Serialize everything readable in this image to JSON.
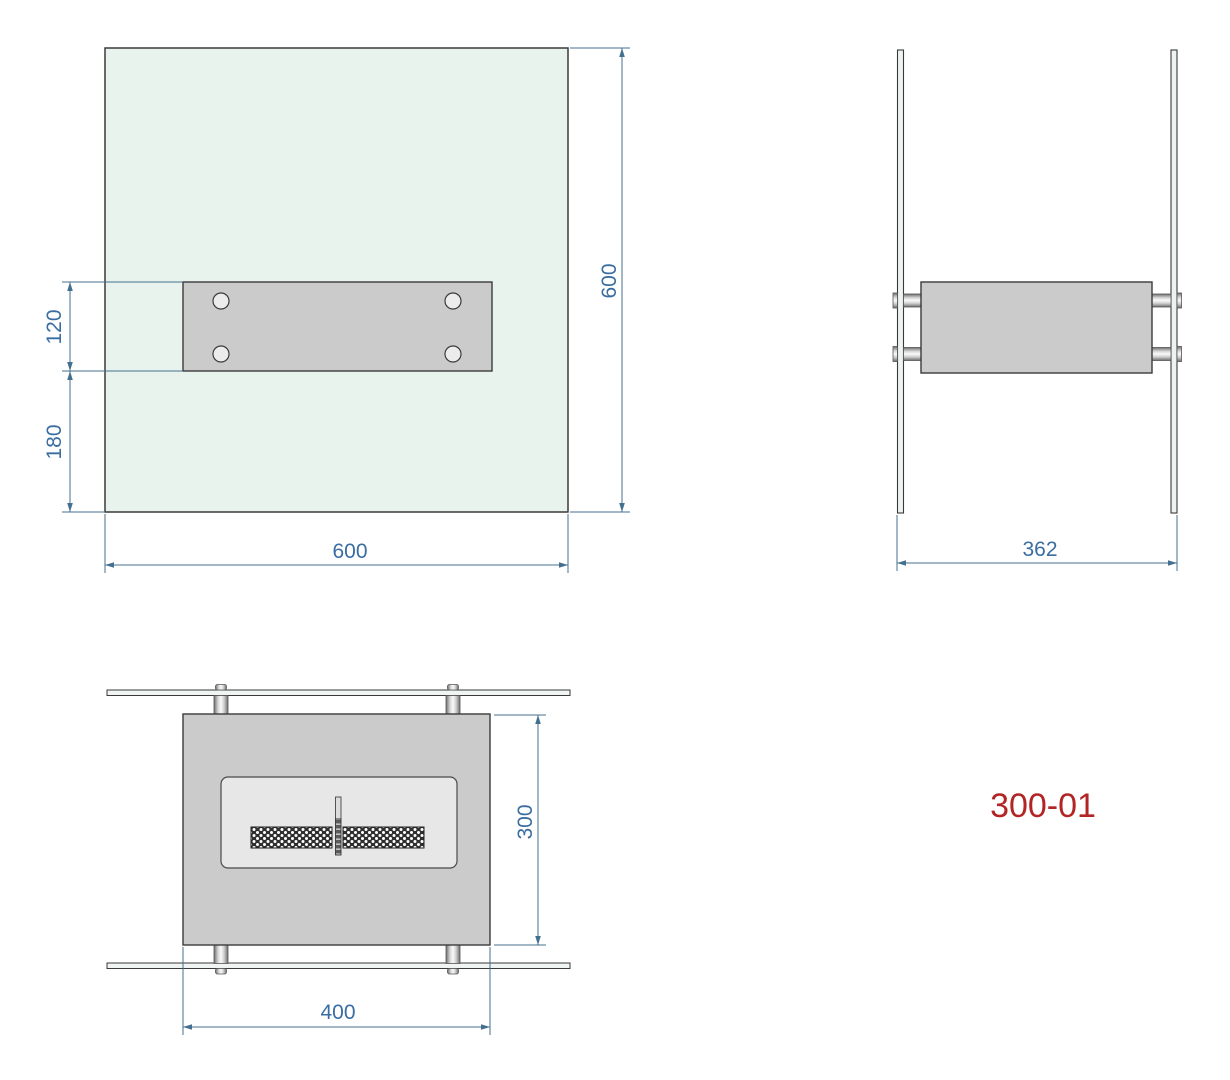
{
  "part_number": "300-01",
  "dims": {
    "front_width": "600",
    "front_height": "600",
    "bracket_height": "120",
    "bracket_offset_bottom": "180",
    "side_depth": "362",
    "top_width": "400",
    "top_depth": "300"
  },
  "colors": {
    "dimension_text_blue": "#3a6da1",
    "dimension_line_blue": "#44708f",
    "part_number_red": "#b32424",
    "glass_mint": "#e9f3ee",
    "metal_gray": "#cbcbcb",
    "inner_panel_gray": "#e7e7e7",
    "mesh_dark": "#2f2f2f"
  }
}
